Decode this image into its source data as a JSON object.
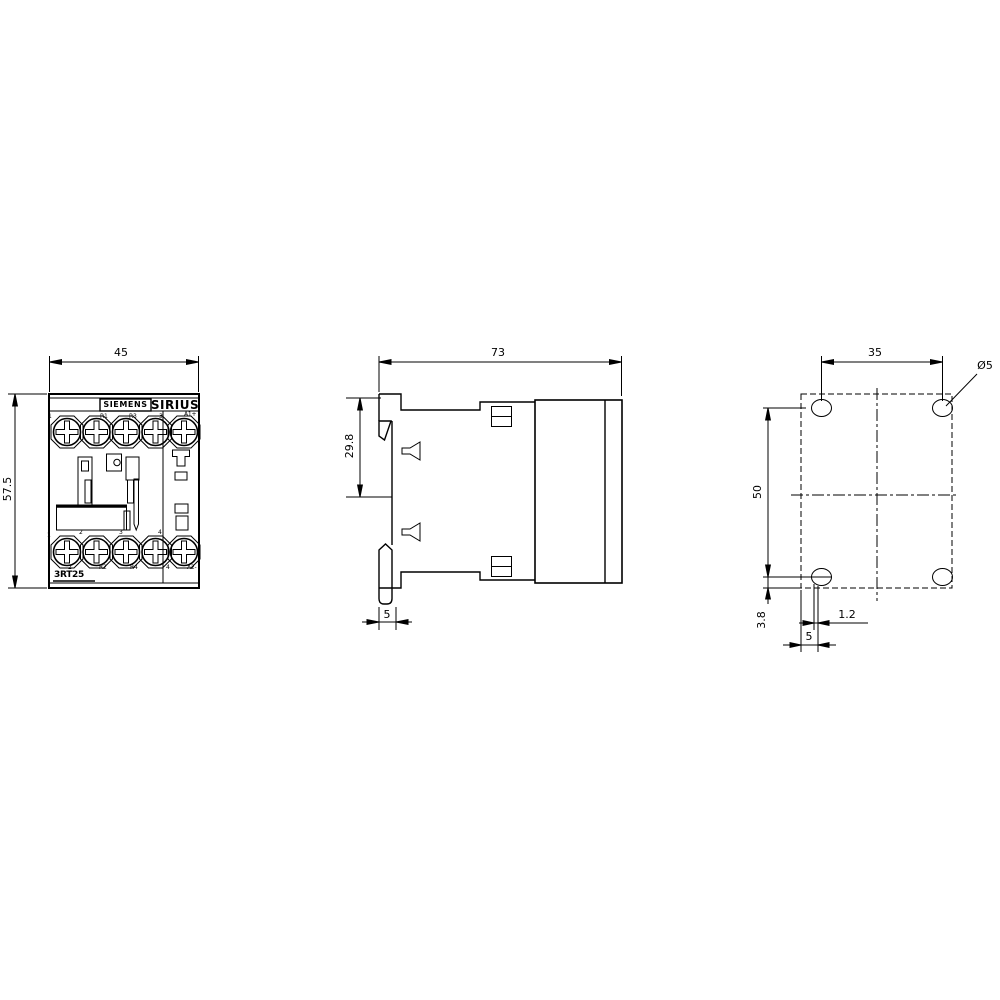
{
  "front_view": {
    "brand": "SIEMENS",
    "series": "SIRIUS",
    "model": "3RT25",
    "top_terminal_labels": [
      "1",
      "R1",
      "R3",
      "3",
      "A1+"
    ],
    "pole_numbers": [
      "1",
      "2",
      "3",
      "4"
    ],
    "bottom_terminal_labels": [
      "2",
      "R2",
      "R4",
      "4",
      "A2-"
    ]
  },
  "dimensions": {
    "front_width": "45",
    "front_height": "57.5",
    "side_depth": "73",
    "rail_seat": "29.8",
    "side_claw_width": "5",
    "hole_spacing_horizontal": "35",
    "hole_spacing_vertical": "50",
    "hole_diameter": "Ø5",
    "bottom_edge_offset": "3.8",
    "hook_offset": "1.2",
    "rail_hook_offset": "5"
  },
  "colors": {
    "line": "#000000",
    "background": "#ffffff"
  }
}
